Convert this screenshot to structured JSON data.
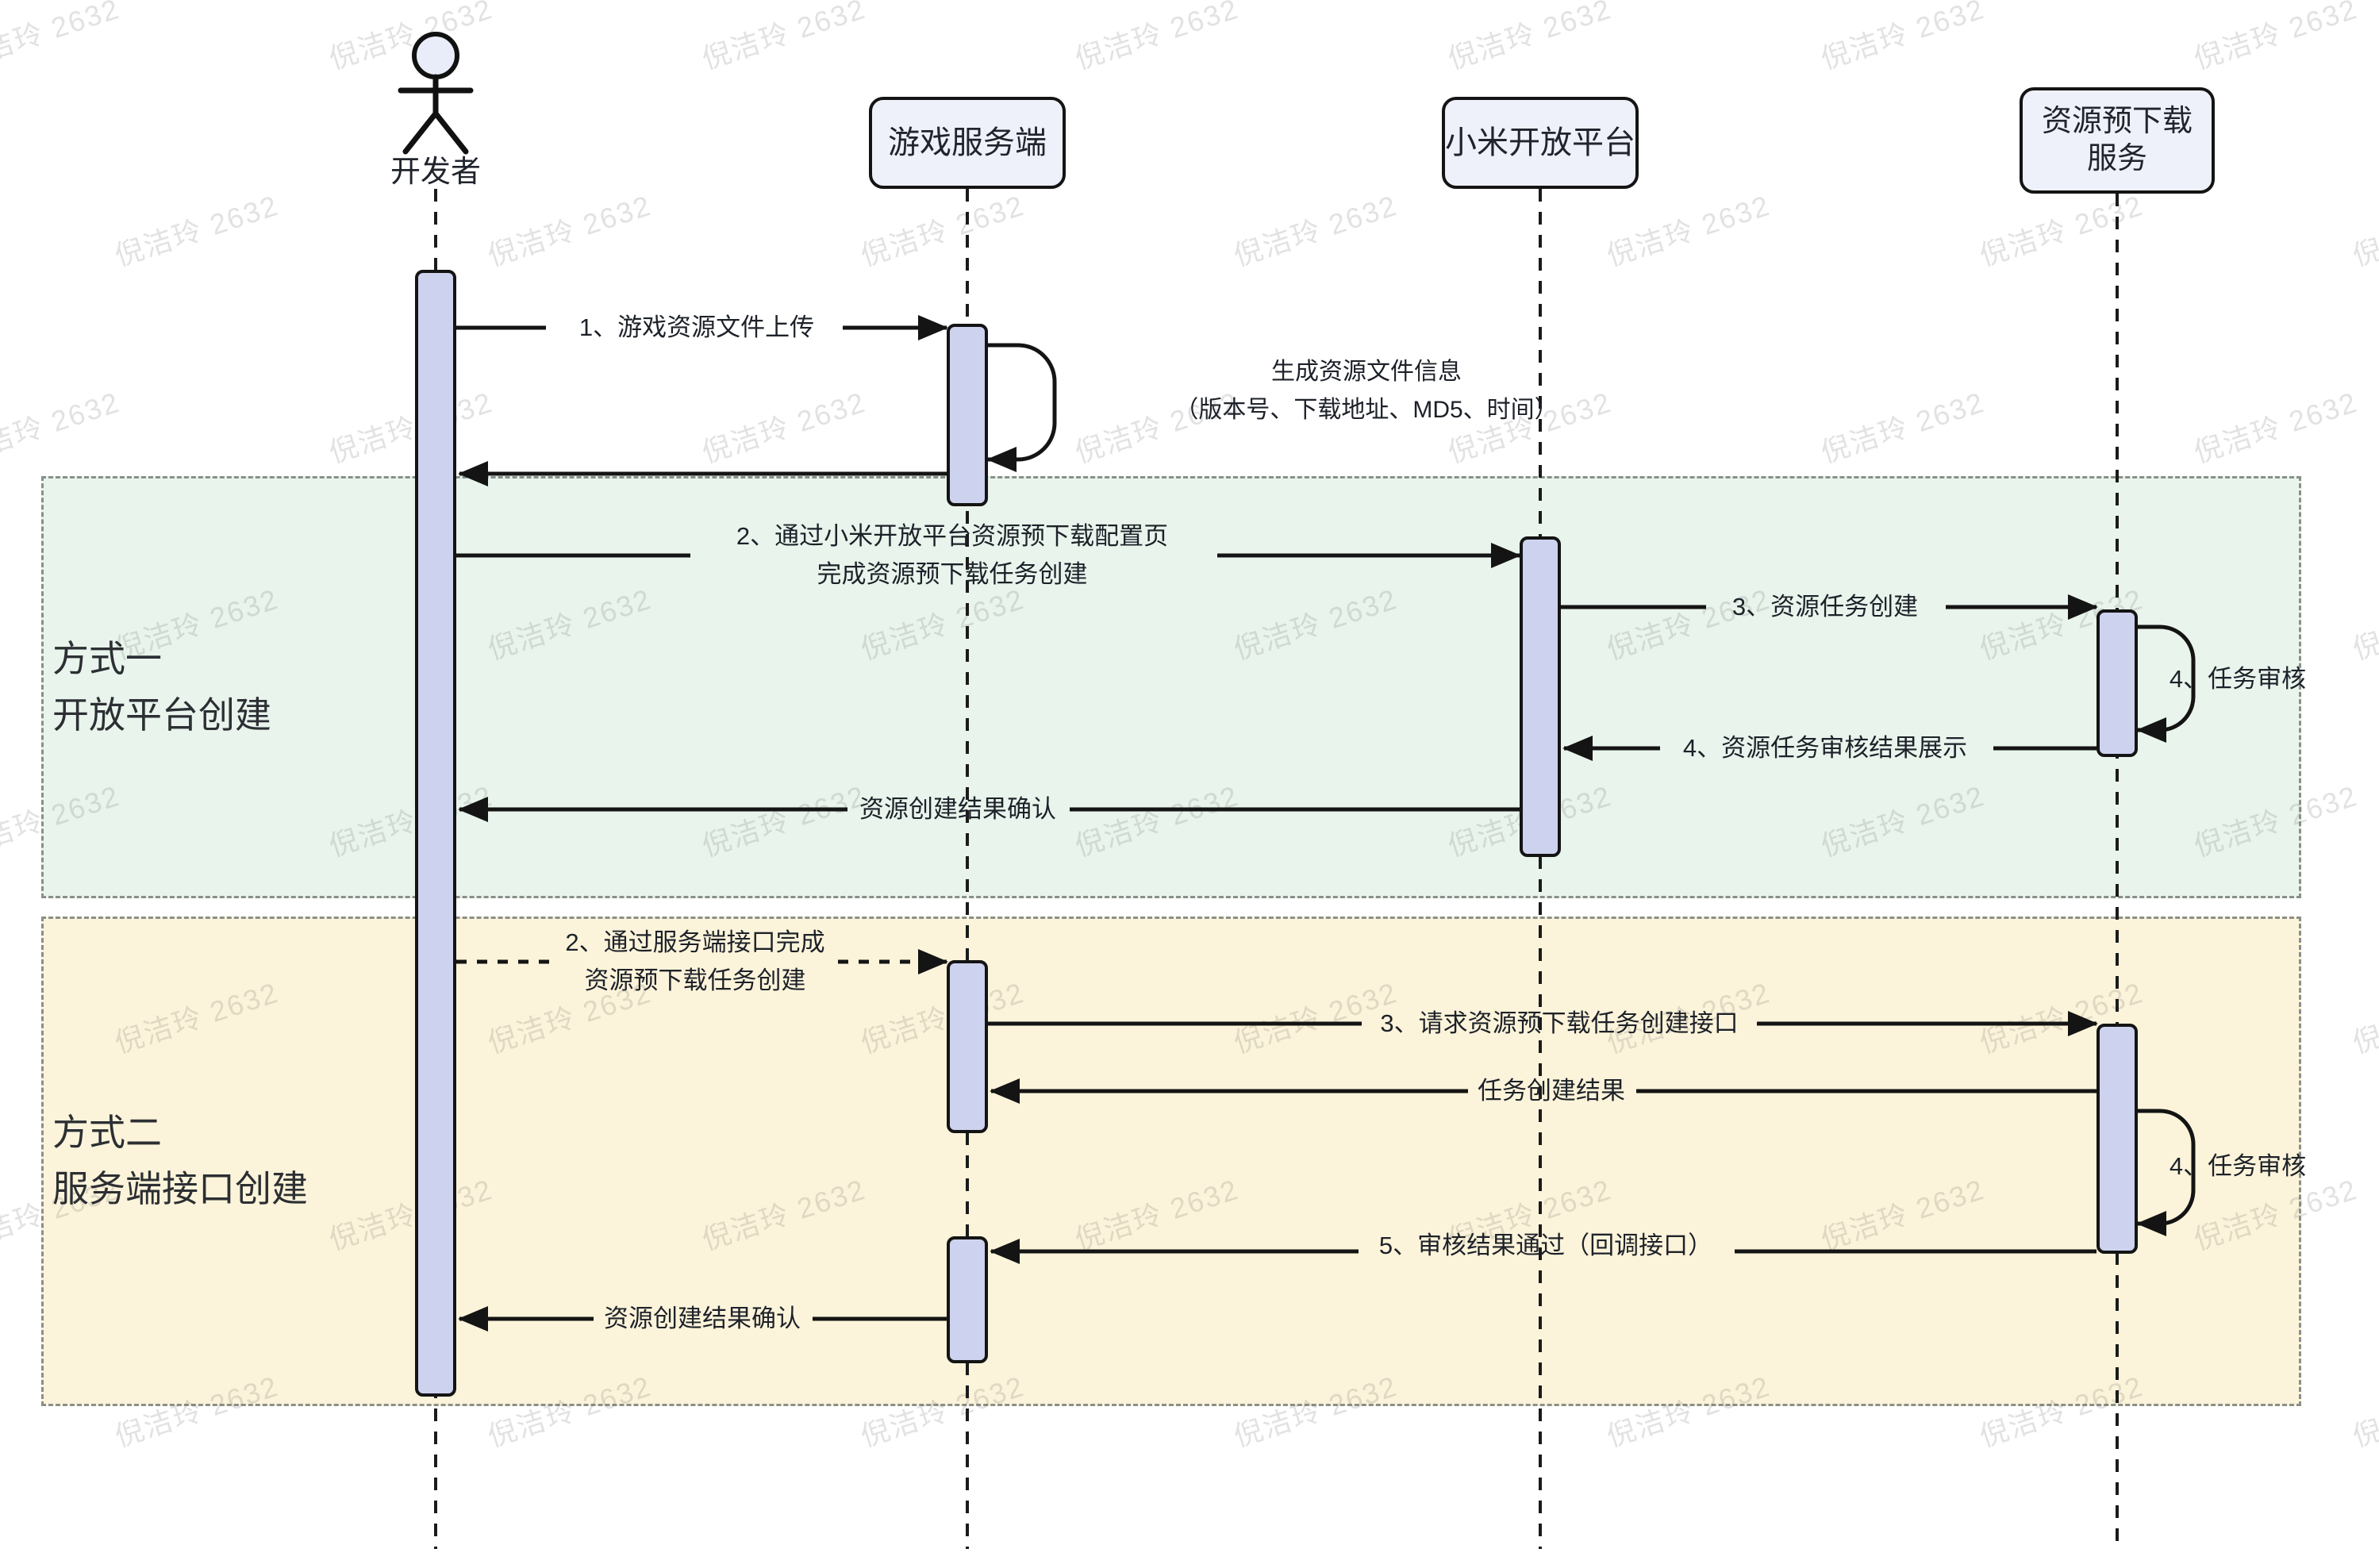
{
  "watermark": {
    "text": "倪洁玲 2632"
  },
  "participants": {
    "developer": {
      "label": "开发者"
    },
    "game_server": {
      "label": "游戏服务端"
    },
    "xiaomi_open_platform": {
      "label": "小米开放平台"
    },
    "predownload_service": {
      "label_line1": "资源预下载",
      "label_line2": "服务"
    }
  },
  "sections": {
    "method1": {
      "title_line1": "方式一",
      "title_line2": "开放平台创建"
    },
    "method2": {
      "title_line1": "方式二",
      "title_line2": "服务端接口创建"
    }
  },
  "messages": {
    "upload": "1、游戏资源文件上传",
    "note_line1": "生成资源文件信息",
    "note_line2": "（版本号、下载地址、MD5、时间）",
    "m1_create_line1": "2、通过小米开放平台资源预下载配置页",
    "m1_create_line2": "完成资源预下载任务创建",
    "m1_task_create": "3、资源任务创建",
    "m1_review": "4、任务审核",
    "m1_review_result": "4、资源任务审核结果展示",
    "m1_confirm": "资源创建结果确认",
    "m2_create_line1": "2、通过服务端接口完成",
    "m2_create_line2": "资源预下载任务创建",
    "m2_request": "3、请求资源预下载任务创建接口",
    "m2_create_result": "任务创建结果",
    "m2_review": "4、任务审核",
    "m2_callback": "5、审核结果通过（回调接口）",
    "m2_confirm": "资源创建结果确认"
  },
  "colors": {
    "method1_region_bg": "#e9f4ec",
    "method2_region_bg": "#fcf4da",
    "activation_bar_fill": "#cdd2ee",
    "participant_box_fill": "#eef1f9",
    "line_color": "#141414",
    "region_border": "#8a8f8a"
  }
}
